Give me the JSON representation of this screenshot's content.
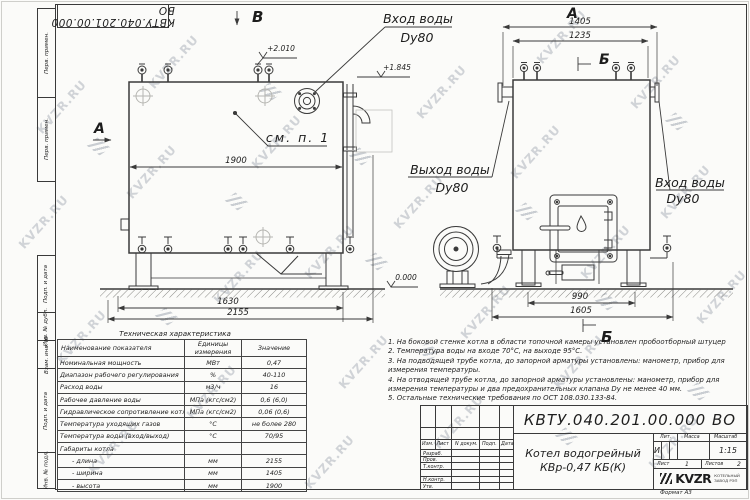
{
  "watermark": {
    "text": "KVZR.RU"
  },
  "sheet": {
    "stamp_top": "КВТУ.040.201.00.000  ВО",
    "format_note": "Формат   А3",
    "margin_labels": [
      "Перв. примен.",
      "Перв. примен.",
      "Подп. и дата",
      "Инв. № дубл.",
      "Взам. инв. №",
      "Подп. и дата",
      "Инв. № подл."
    ]
  },
  "drawing": {
    "left_view": {
      "label_top": "В",
      "label_side": "А",
      "pipe_label_1": "Вход воды",
      "pipe_label_2": "Dy80",
      "elev_top": "+2.010",
      "elev_pipe": "+1.845",
      "elev_ground": "0.000",
      "note_ref": "см. п. 1",
      "dim_width": "1900",
      "dim_support": "1630",
      "dim_overall": "2155"
    },
    "right_view": {
      "label_top": "А",
      "section_top": "Б",
      "section_bottom": "Б",
      "outlet_1": "Выход воды",
      "outlet_2": "Dy80",
      "inlet_1": "Вход воды",
      "inlet_2": "Dy80",
      "dim_top_overall": "1405",
      "dim_top_body": "1235",
      "dim_base": "990",
      "dim_base_overall": "1605"
    }
  },
  "spec_table": {
    "title": "Техническая характеристика",
    "header_name": "Наименование показателя",
    "header_unit_1": "Единицы",
    "header_unit_2": "измерения",
    "header_value": "Значение",
    "rows": [
      {
        "name": "Номинальная мощность",
        "unit": "МВт",
        "value": "0,47"
      },
      {
        "name": "Диапазон рабочего регулирования",
        "unit": "%",
        "value": "40-110"
      },
      {
        "name": "Расход воды",
        "unit": "м3/ч",
        "value": "16"
      },
      {
        "name": "Рабочее давление воды",
        "unit": "МПа (кгс/см2)",
        "value": "0,6 (6,0)"
      },
      {
        "name": "Гидравлическое сопротивление котла",
        "unit": "МПа (кгс/см2)",
        "value": "0,06 (0,6)"
      },
      {
        "name": "Температура уходящих газов",
        "unit": "°С",
        "value": "не более 280"
      },
      {
        "name": "Температура воды (вход/выход)",
        "unit": "°С",
        "value": "70/95"
      },
      {
        "name": "Габариты котла",
        "unit": "",
        "value": ""
      },
      {
        "name": "- длина",
        "unit": "мм",
        "value": "2155"
      },
      {
        "name": "- ширина",
        "unit": "мм",
        "value": "1405"
      },
      {
        "name": "- высота",
        "unit": "мм",
        "value": "1900"
      }
    ]
  },
  "notes": {
    "lines": [
      "1.  На боковой стенке котла в области топочной камеры установлен пробоотборный штуцер",
      "2.  Температура воды на входе  70°С,  на выходе  95°С.",
      "3.  На подводящей трубе котла, до запорной арматуры установлены:  манометр,  прибор для",
      "измерения температуры.",
      "4.  На отводящей трубе котла, до запорной арматуры установлены:  манометр,  прибор для",
      "измерения температуры и два предохранительных клапана  Dу не менее  40 мм.",
      "5.  Остальные технические требования по ОСТ  108.030.133-84."
    ]
  },
  "title_block": {
    "doc_number": "КВТУ.040.201.00.000  ВО",
    "product_line1": "Котел водогрейный",
    "product_line2": "КВр-0,47 КБ(К)",
    "col_izm": "Изм.",
    "col_list": "Лист",
    "col_doc": "N докум.",
    "col_sign": "Подп.",
    "col_date": "Дата",
    "row_developed": "Разраб.",
    "row_checked": "Пров.",
    "row_tcontrol": "Т.контр.",
    "row_ncontrol": "Н.контр.",
    "row_approved": "Утв.",
    "lit_label": "Лит.",
    "lit_value": "И",
    "mass_label": "Масса",
    "scale_label": "Масштаб",
    "scale_value": "1:15",
    "sheet_label": "Лист",
    "sheet_value": "1",
    "sheets_label": "Листов",
    "sheets_value": "2",
    "logo_text": "KVZR",
    "logo_caption1": "КОТЕЛЬНЫЙ",
    "logo_caption2": "ЗАВОД РЭП"
  }
}
